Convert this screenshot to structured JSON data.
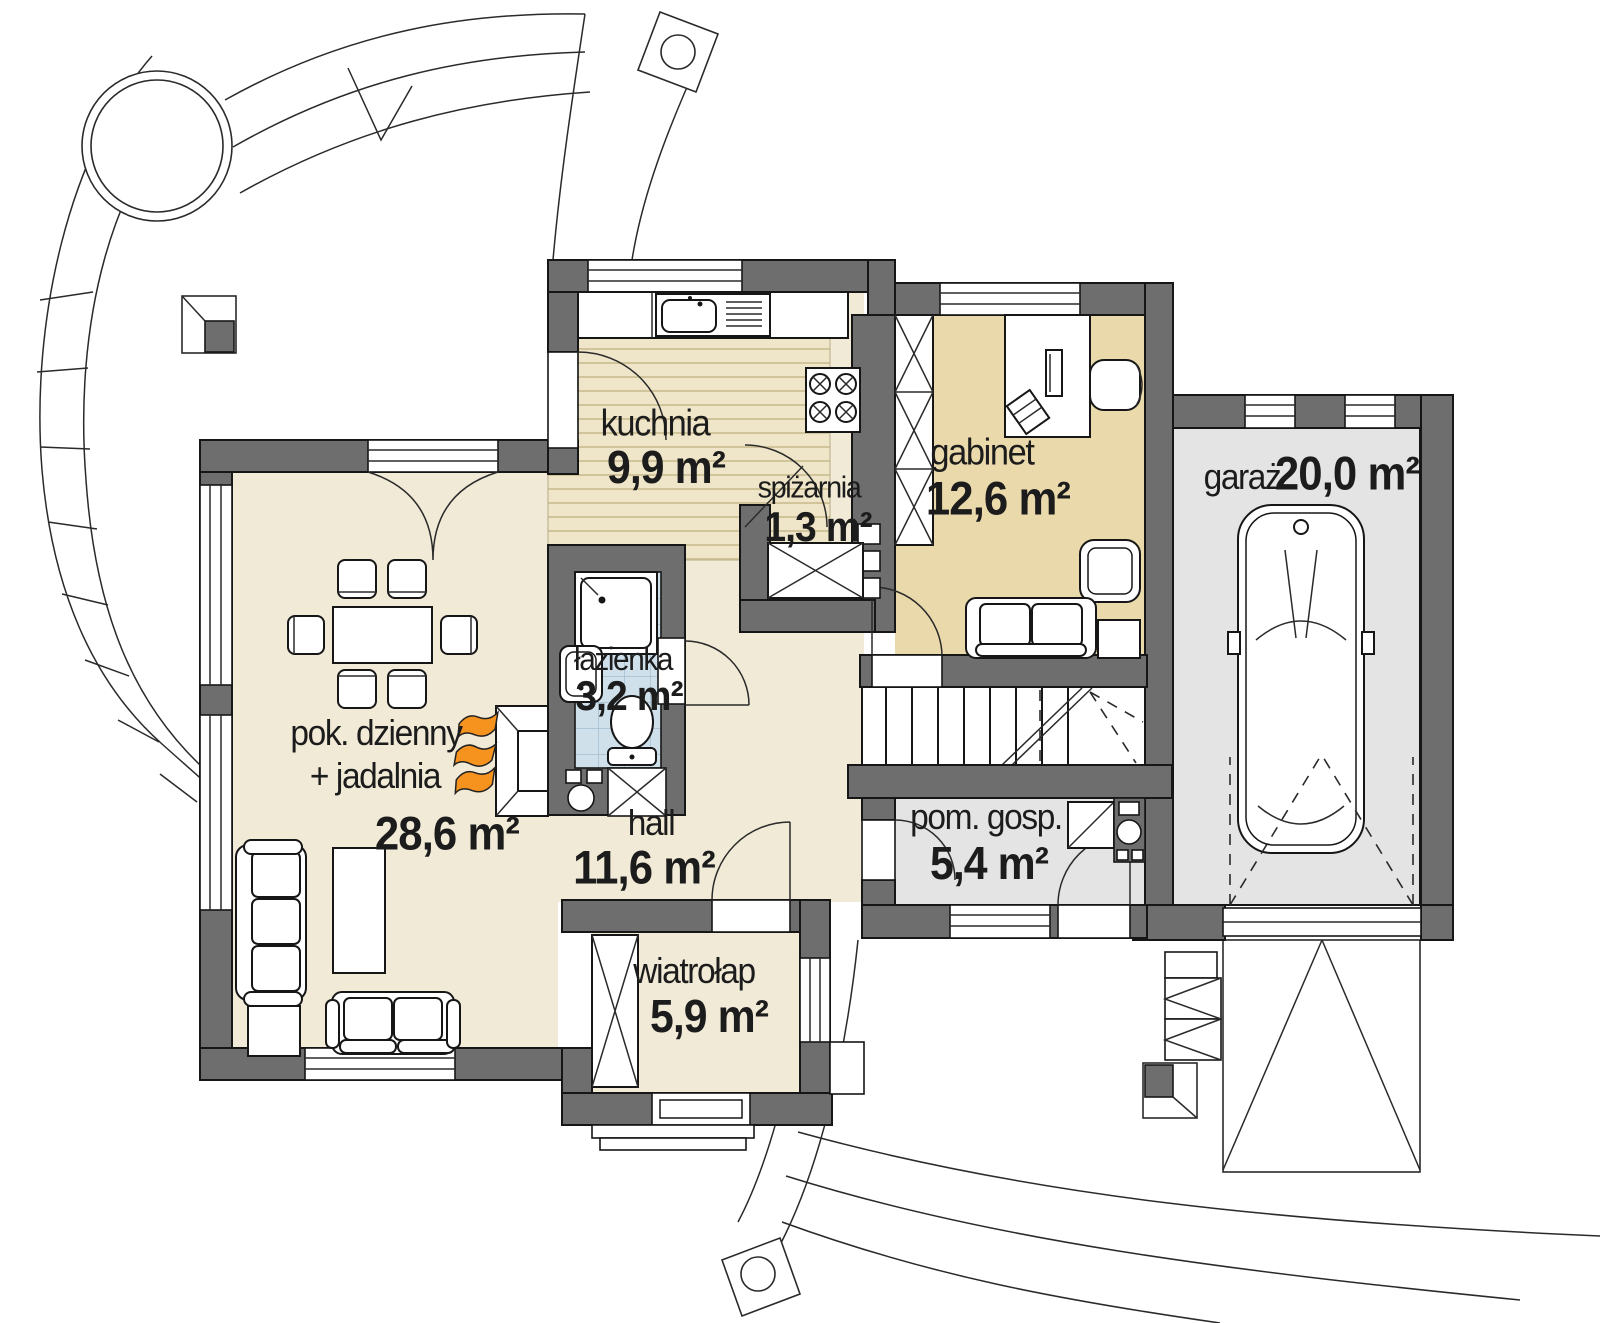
{
  "plan": {
    "type": "house-ground-floor-plan",
    "language": "pl"
  },
  "rooms": {
    "kuchnia": {
      "name": "kuchnia",
      "area": "9,9 m²"
    },
    "spizarnia": {
      "name": "spiżarnia",
      "area": "1,3 m²"
    },
    "gabinet": {
      "name": "gabinet",
      "area": "12,6 m²"
    },
    "garaz": {
      "name": "garaż",
      "area": "20,0 m²"
    },
    "pok_dzienny": {
      "name": "pok. dzienny",
      "name2": "+ jadalnia",
      "area": "28,6 m²"
    },
    "lazienka": {
      "name": "łazienka",
      "area": "3,2 m²"
    },
    "hall": {
      "name": "hall",
      "area": "11,6 m²"
    },
    "pom_gosp": {
      "name": "pom. gosp.",
      "area": "5,4 m²"
    },
    "wiatrolap": {
      "name": "wiatrołap",
      "area": "5,9 m²"
    }
  },
  "colors": {
    "wall": "#6e6e6e",
    "floor_cream": "#f1ead7",
    "floor_wood": "#efe6c9",
    "floor_tan": "#e9d9ab",
    "floor_tile": "#cfe0ea",
    "floor_gray": "#e4e4e4",
    "flame_orange": "#f6921e",
    "line": "#1a1a1a"
  }
}
